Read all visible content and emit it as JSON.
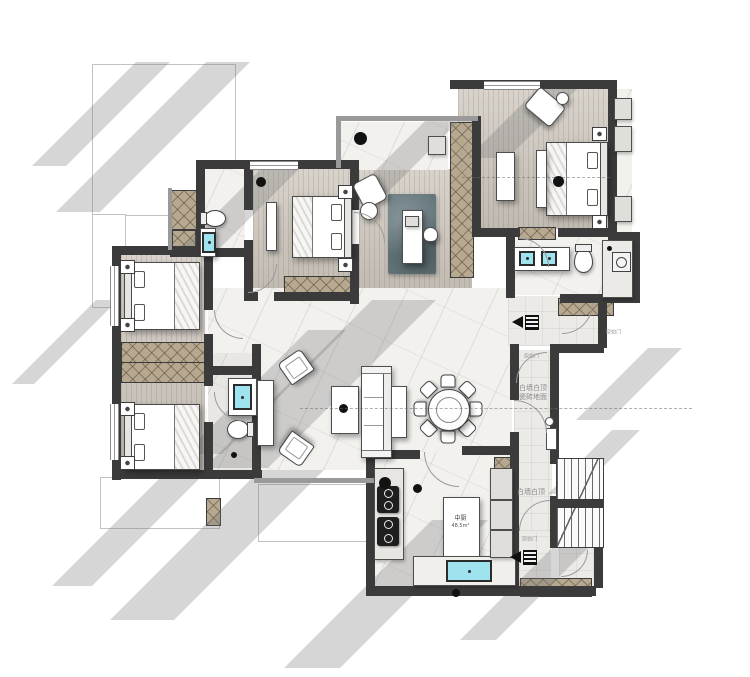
{
  "plan": {
    "title": "rendered-apartment-floor-plan",
    "notes": {
      "corridor_upper_line1": "白墙白顶",
      "corridor_upper_line2": "瓷砖地面",
      "corridor_lower": "白墙白顶",
      "door_tag": "原始门"
    },
    "kitchen": {
      "name": "中厨",
      "area": "48.5m²"
    },
    "colors": {
      "wall": "#3b3b3b",
      "wood_floor": "#cbc4ba",
      "marble_floor": "#f2f1ee",
      "wardrobe_hatch": "#b7a890",
      "fixture_cyan": "#9fe3ee",
      "shadow_gray": "#c7c7c7",
      "rug_blue": "#64767c"
    }
  }
}
